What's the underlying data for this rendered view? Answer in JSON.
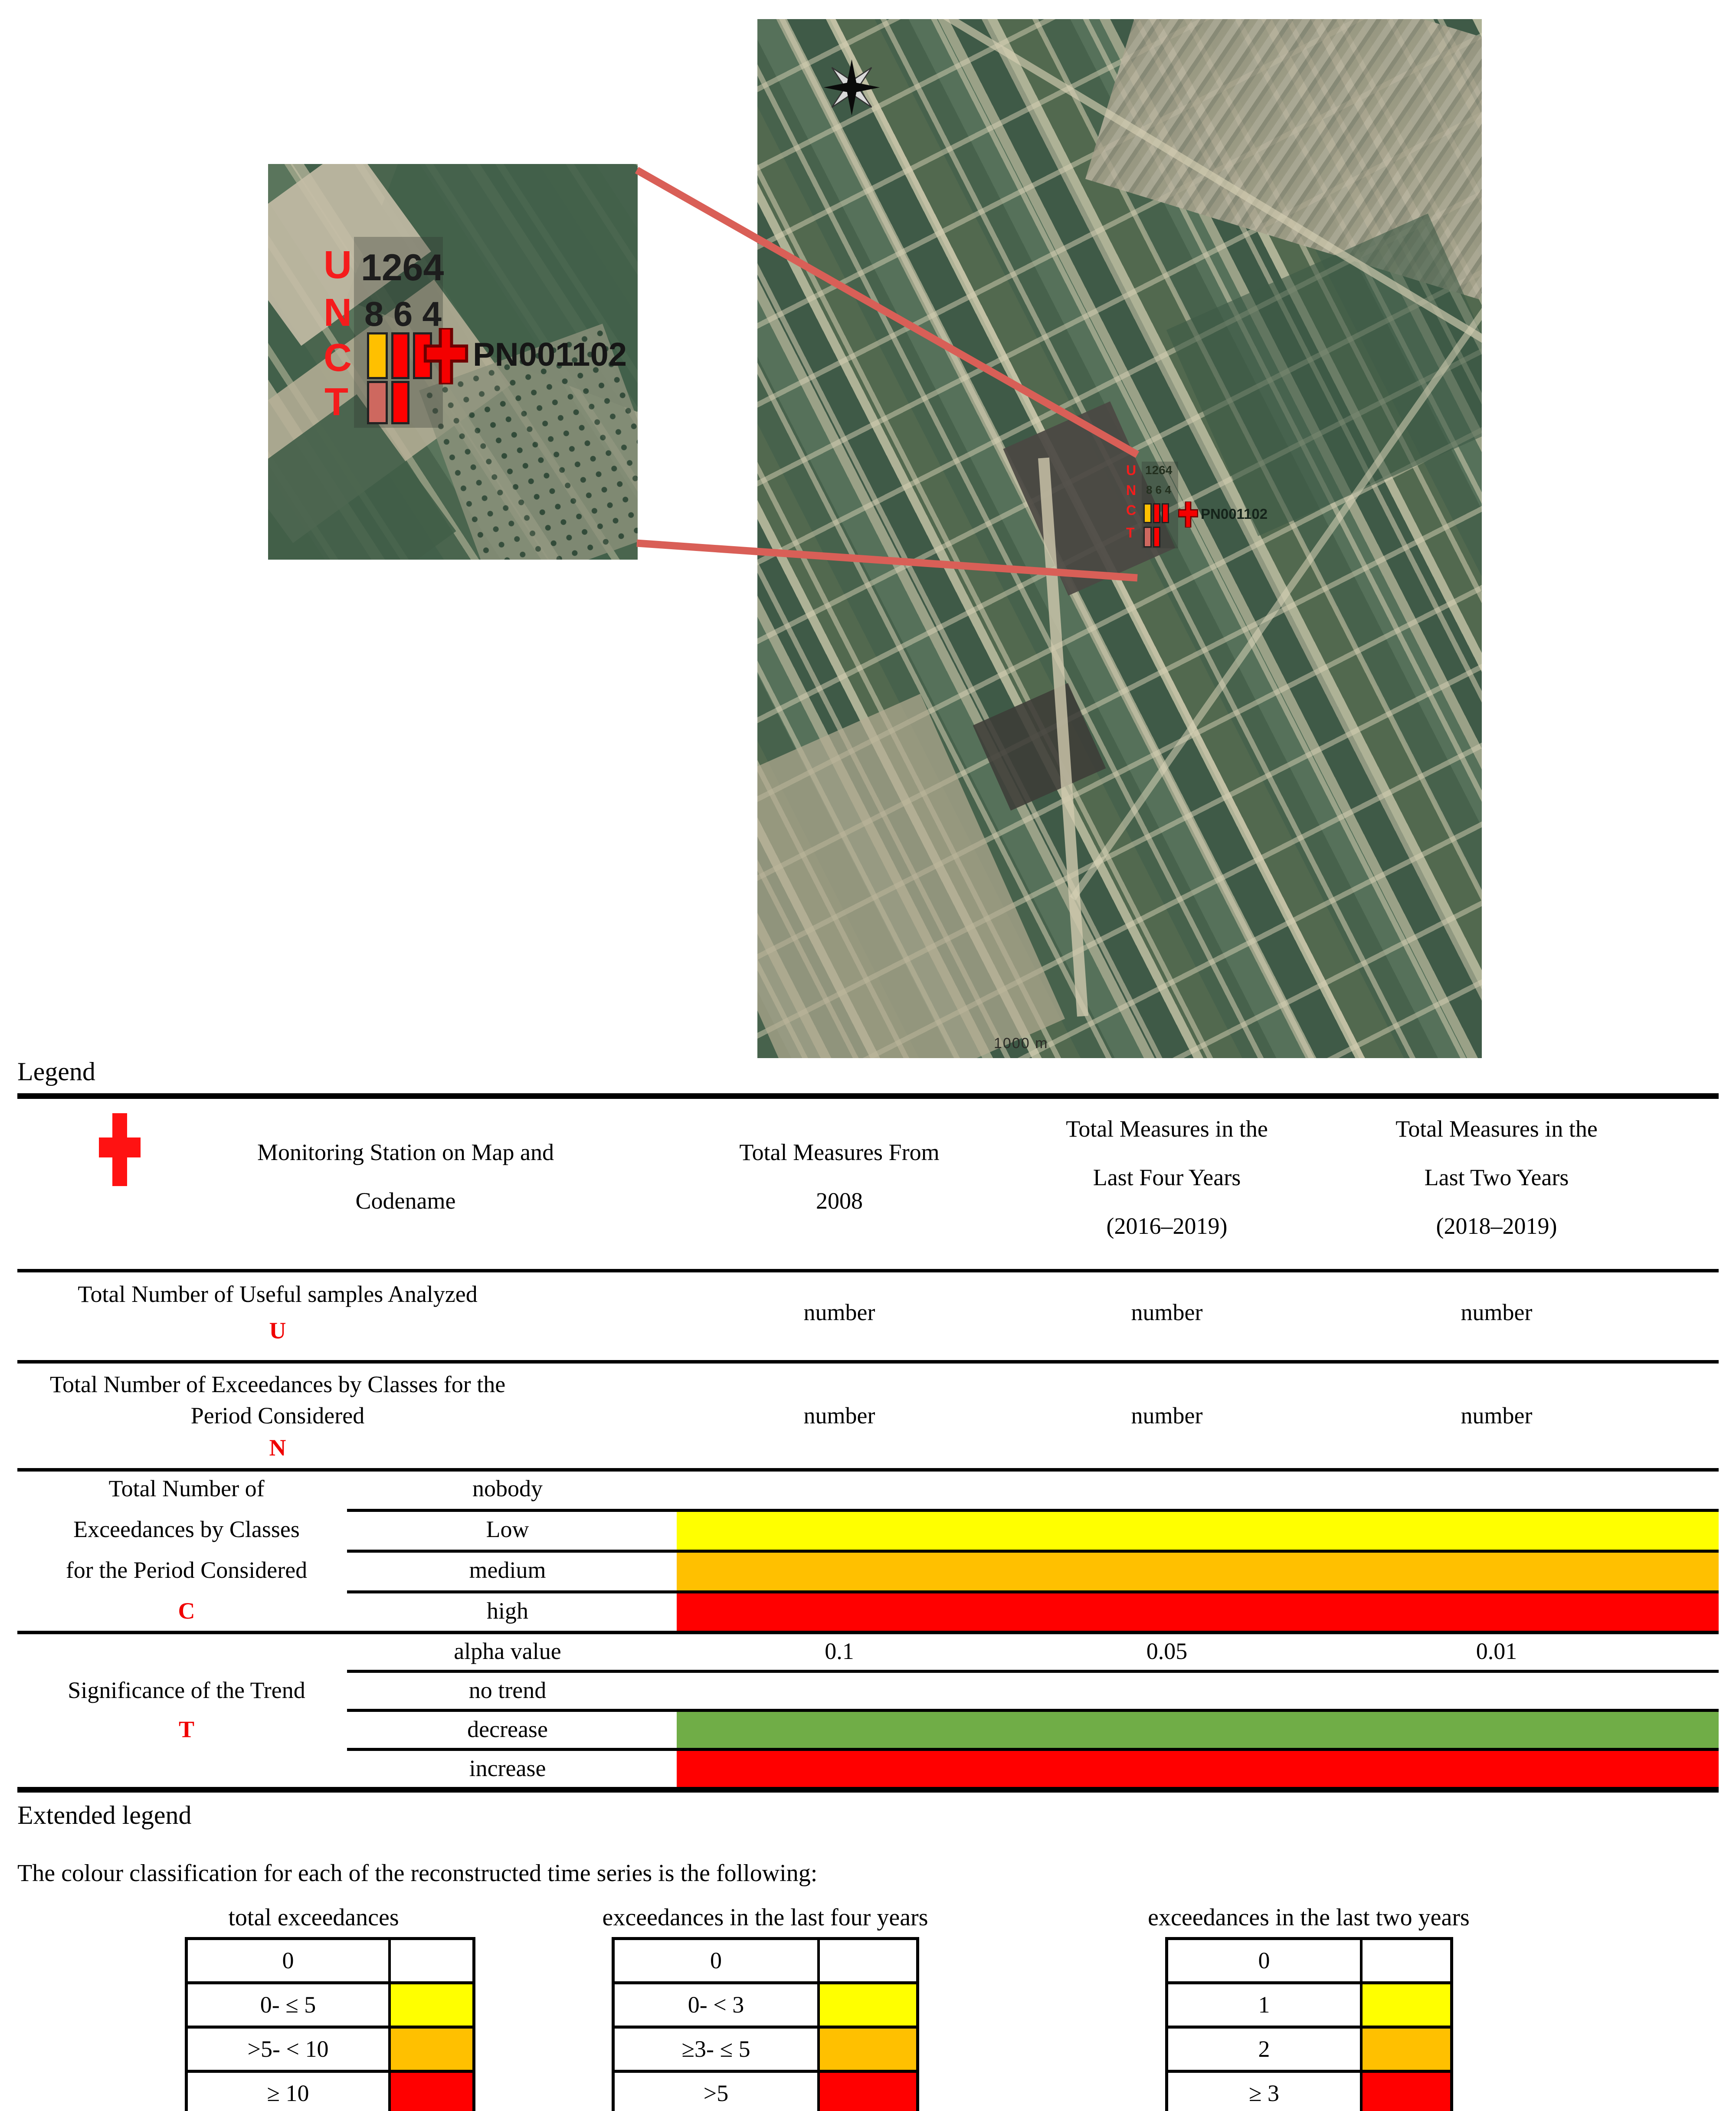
{
  "colors": {
    "yellow": "#FFFF00",
    "orange": "#FFC000",
    "red": "#FF0000",
    "green": "#70AD47",
    "salmon": "#CE685F",
    "station_red": "#F51C1C",
    "connector_red": "#D95F57"
  },
  "map": {
    "station": {
      "codename": "PN001102",
      "letter_u": "U",
      "letter_n": "N",
      "letter_c": "C",
      "letter_t": "T",
      "u_value": "1264",
      "n_values": "8 6 4"
    },
    "scale_label": "1000 m"
  },
  "legend": {
    "title": "Legend",
    "header": {
      "station_line1": "Monitoring Station on Map and",
      "station_line2": "Codename",
      "from2008_line1": "Total Measures From",
      "from2008_line2": "2008",
      "four_years_line1": "Total Measures in the",
      "four_years_line2": "Last Four Years",
      "four_years_line3": "(2016–2019)",
      "two_years_line1": "Total Measures in the",
      "two_years_line2": "Last Two Years",
      "two_years_line3": "(2018–2019)"
    },
    "row_u": {
      "label": "Total Number of Useful samples Analyzed",
      "letter": "U",
      "values": [
        "number",
        "number",
        "number"
      ]
    },
    "row_n": {
      "label_line1": "Total Number of Exceedances by Classes for the",
      "label_line2": "Period Considered",
      "letter": "N",
      "values": [
        "number",
        "number",
        "number"
      ]
    },
    "section_c": {
      "label_line1": "Total Number of",
      "label_line2": "Exceedances by Classes",
      "label_line3": "for the Period Considered",
      "letter": "C",
      "rows": [
        {
          "label": "nobody",
          "color": "none"
        },
        {
          "label": "Low",
          "color": "#FFFF00"
        },
        {
          "label": "medium",
          "color": "#FFC000"
        },
        {
          "label": "high",
          "color": "#FF0000"
        }
      ]
    },
    "section_t": {
      "label": "Significance of the Trend",
      "letter": "T",
      "alpha_label": "alpha value",
      "alpha_values": [
        "0.1",
        "0.05",
        "0.01"
      ],
      "rows": [
        {
          "label": "no trend",
          "color": "none"
        },
        {
          "label": "decrease",
          "color": "#70AD47"
        },
        {
          "label": "increase",
          "color": "#FF0000"
        }
      ]
    }
  },
  "extended": {
    "title": "Extended legend",
    "intro": "The colour classification for each of the reconstructed time series is the following:",
    "tables": [
      {
        "title": "total exceedances",
        "rows": [
          {
            "label": "0",
            "color": "none"
          },
          {
            "label": "0- ≤ 5",
            "color": "#FFFF00"
          },
          {
            "label": ">5- < 10",
            "color": "#FFC000"
          },
          {
            "label": "≥ 10",
            "color": "#FF0000"
          }
        ]
      },
      {
        "title": "exceedances in the last four years",
        "rows": [
          {
            "label": "0",
            "color": "none"
          },
          {
            "label": "0- < 3",
            "color": "#FFFF00"
          },
          {
            "label": "≥3- ≤ 5",
            "color": "#FFC000"
          },
          {
            "label": ">5",
            "color": "#FF0000"
          }
        ]
      },
      {
        "title": "exceedances in the last two years",
        "rows": [
          {
            "label": "0",
            "color": "none"
          },
          {
            "label": "1",
            "color": "#FFFF00"
          },
          {
            "label": "2",
            "color": "#FFC000"
          },
          {
            "label": "≥ 3",
            "color": "#FF0000"
          }
        ]
      }
    ]
  }
}
